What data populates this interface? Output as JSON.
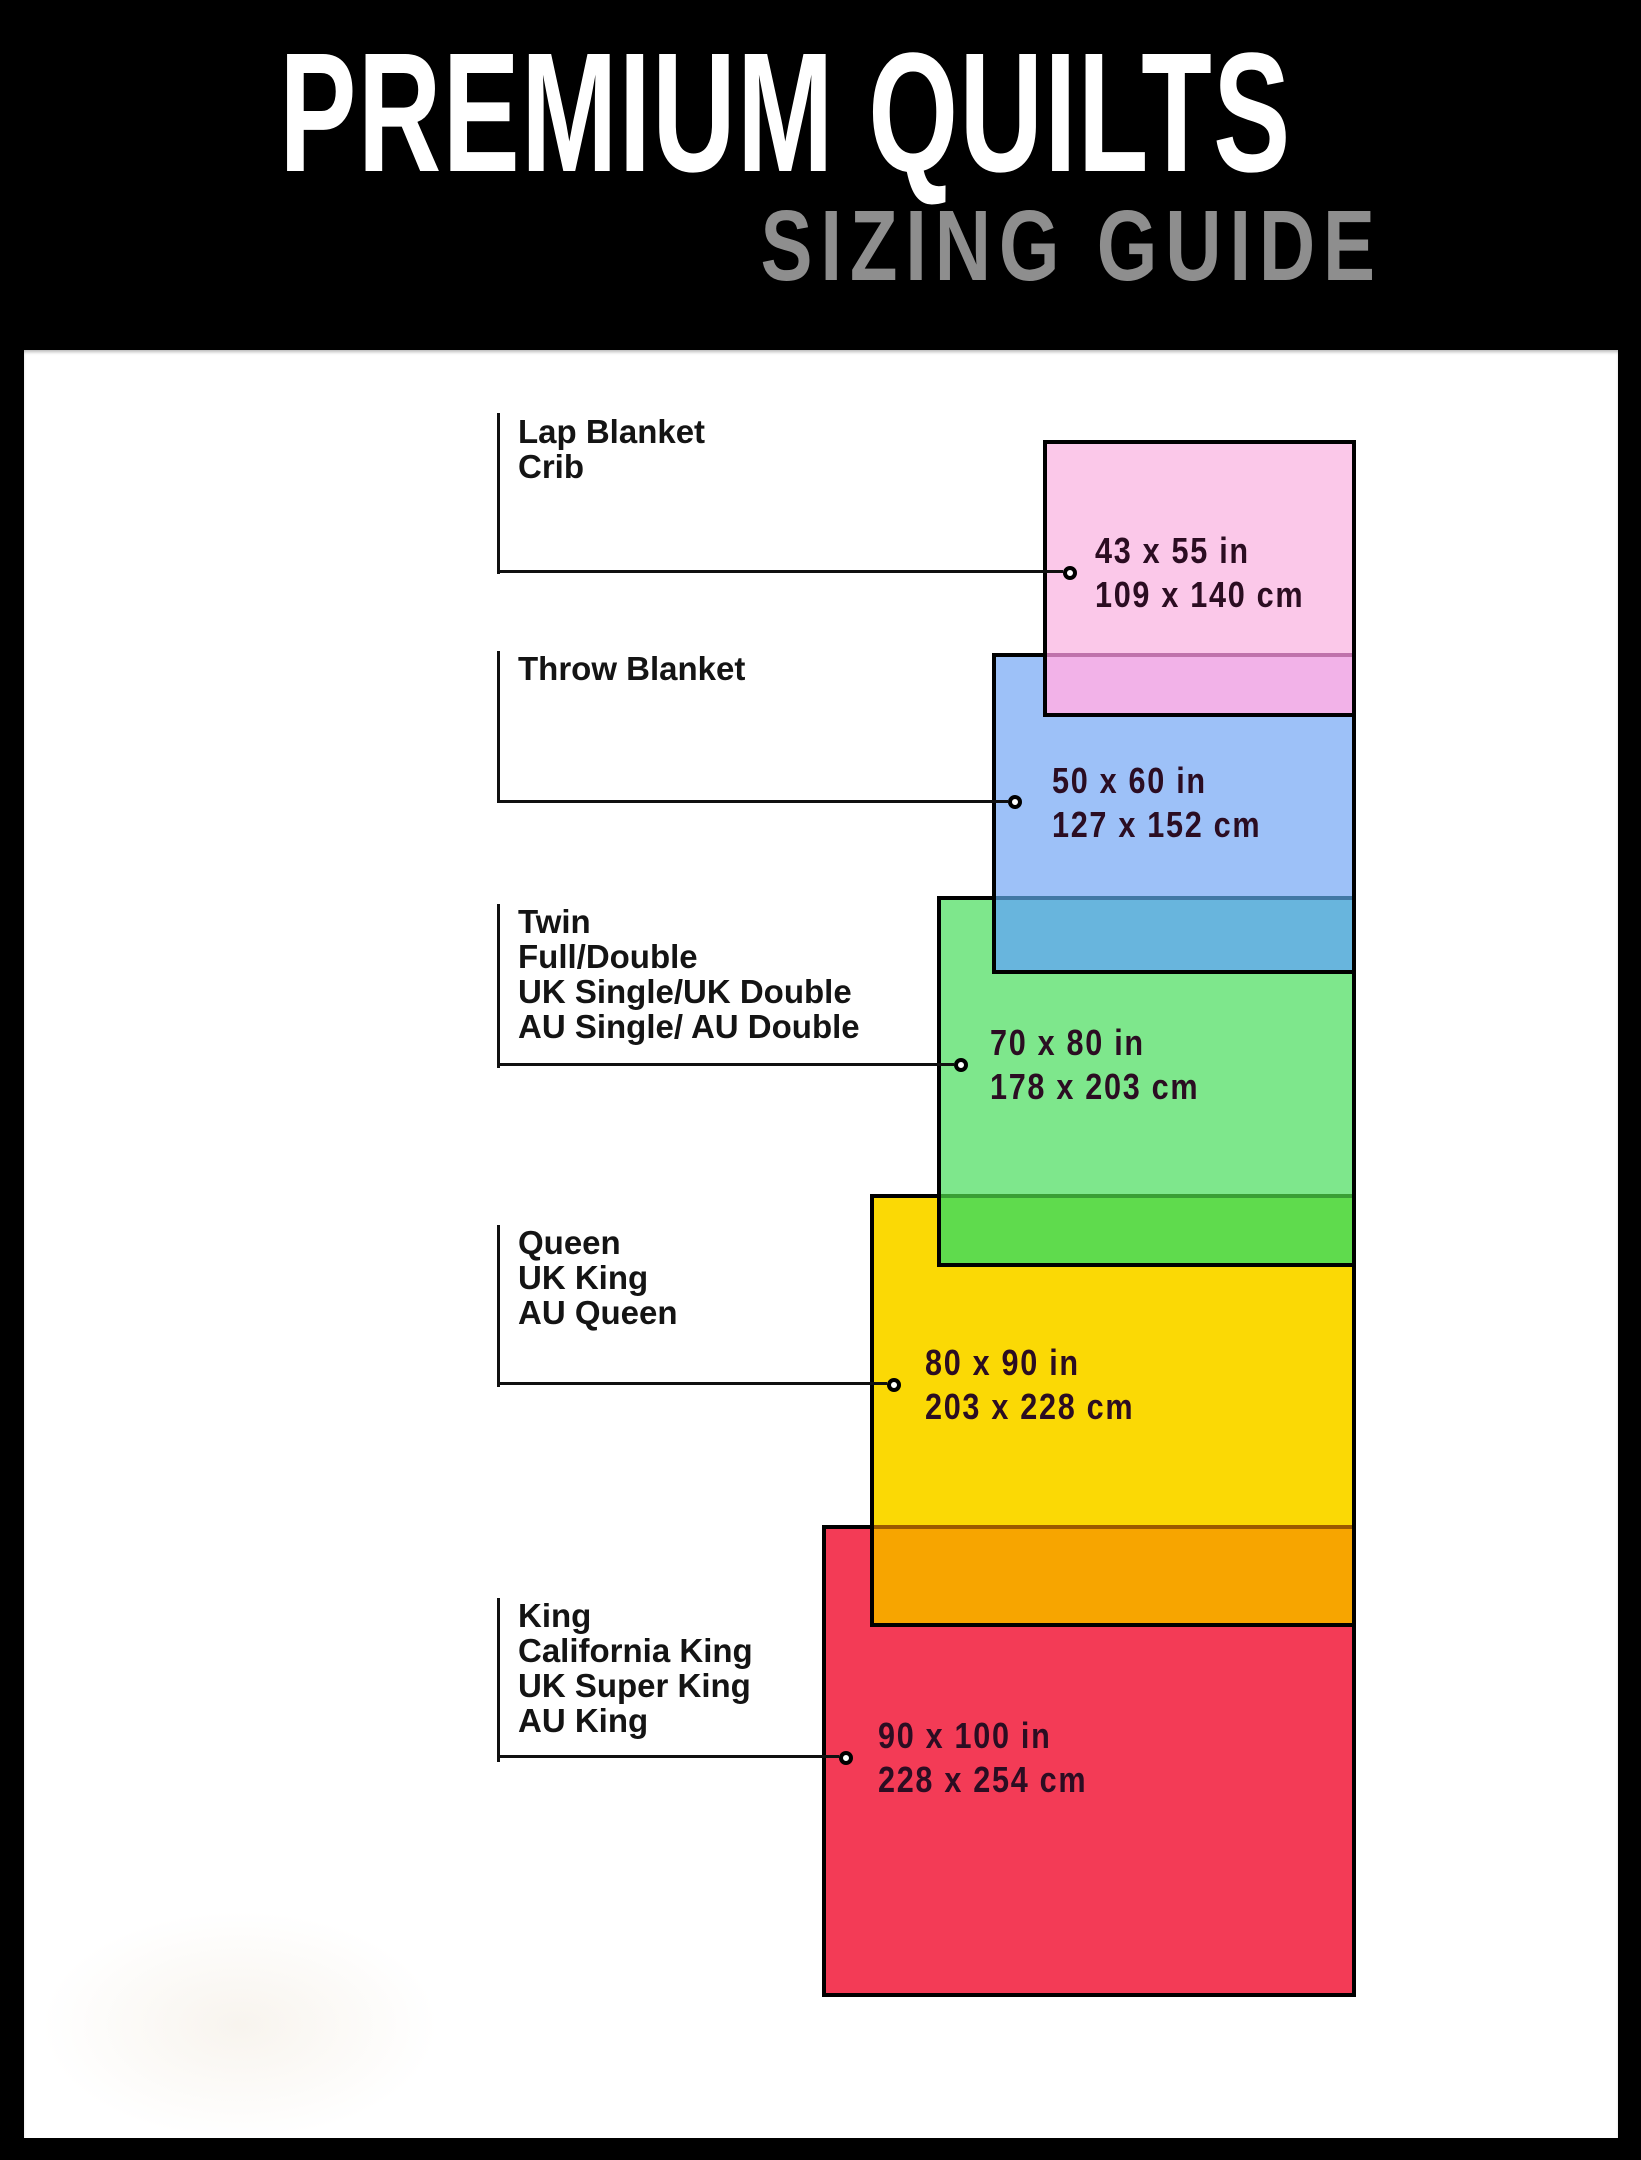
{
  "header": {
    "title": "PREMIUM QUILTS",
    "subtitle": "SIZING GUIDE"
  },
  "sizes": [
    {
      "name": "lap-blanket-crib",
      "labels": [
        "Lap Blanket",
        "Crib"
      ],
      "inches": "43 x 55 in",
      "cm": "109 x 140 cm",
      "fill": "#FBC8E9",
      "overlap_fill": "#F2B2E8"
    },
    {
      "name": "throw-blanket",
      "labels": [
        "Throw Blanket"
      ],
      "inches": "50 x 60 in",
      "cm": "127 x 152 cm",
      "fill": "#9DC1F8",
      "overlap_fill": "#68B5DD"
    },
    {
      "name": "twin-full-double",
      "labels": [
        "Twin",
        "Full/Double",
        "UK Single/UK Double",
        "AU Single/ AU Double"
      ],
      "inches": "70 x 80 in",
      "cm": "178 x 203 cm",
      "fill": "#7EE78C",
      "overlap_fill": "#5FDB4D"
    },
    {
      "name": "queen",
      "labels": [
        "Queen",
        "UK King",
        "AU Queen"
      ],
      "inches": "80 x 90 in",
      "cm": "203 x 228 cm",
      "fill": "#FBD905",
      "overlap_fill": "#F7A500"
    },
    {
      "name": "king",
      "labels": [
        "King",
        "California King",
        "UK Super King",
        "AU King"
      ],
      "inches": "90 x 100 in",
      "cm": "228 x 254 cm",
      "fill": "#F33B56",
      "overlap_fill": ""
    }
  ],
  "colors": {
    "background": "#000000",
    "panel": "#FFFFFF",
    "title_text": "#FFFFFF",
    "subtitle_text": "#8E8E8E",
    "label_text": "#141414",
    "dimension_text": "#2B0D22",
    "connector_line": "#101010"
  }
}
